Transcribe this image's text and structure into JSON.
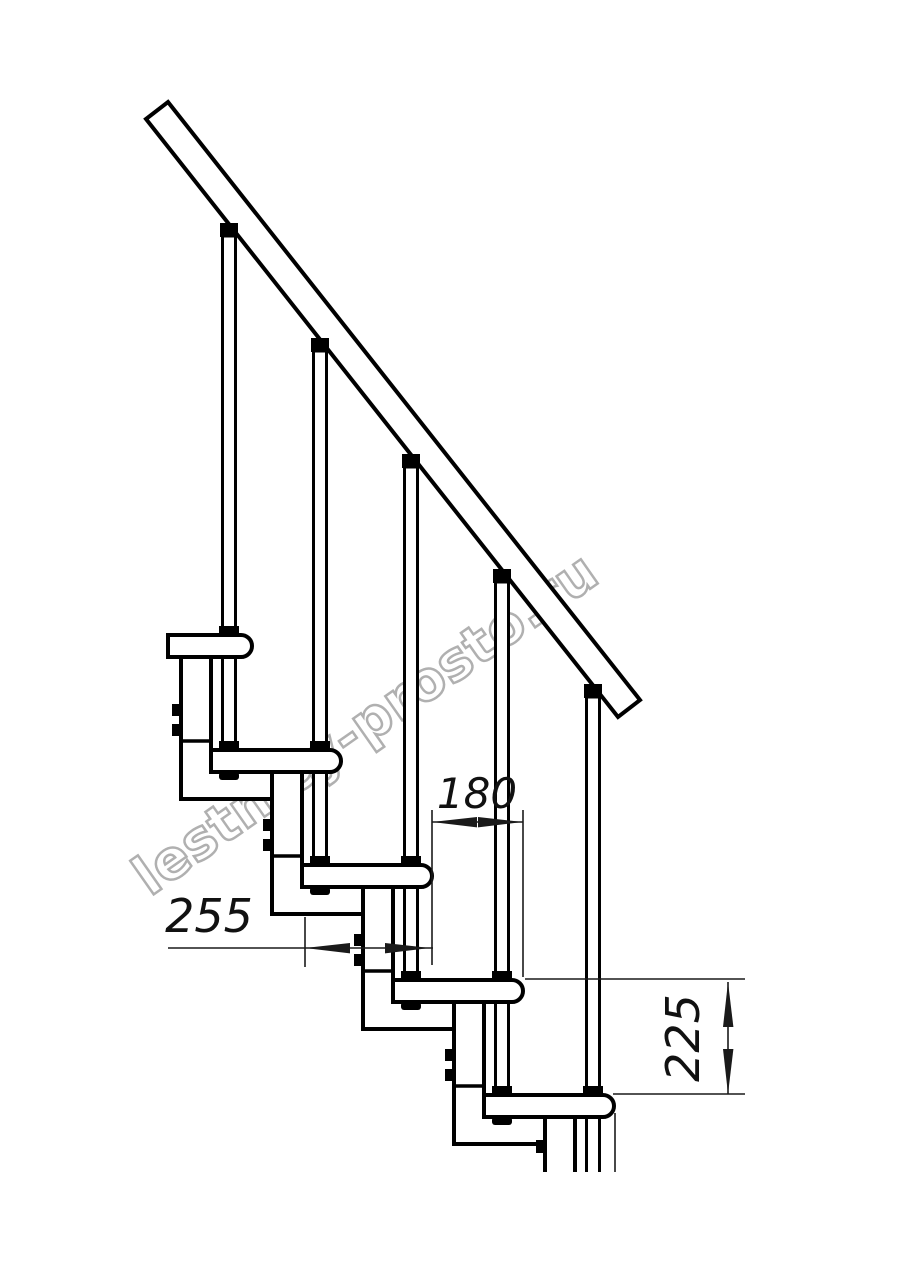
{
  "watermark": {
    "text": "lestnicy-prosto.ru",
    "color": "#b0b0b0"
  },
  "dims": {
    "run": "180",
    "depth": "255",
    "rise": "225"
  },
  "colors": {
    "line": "#000000",
    "dim": "#1a1a1a",
    "background": "#ffffff"
  }
}
